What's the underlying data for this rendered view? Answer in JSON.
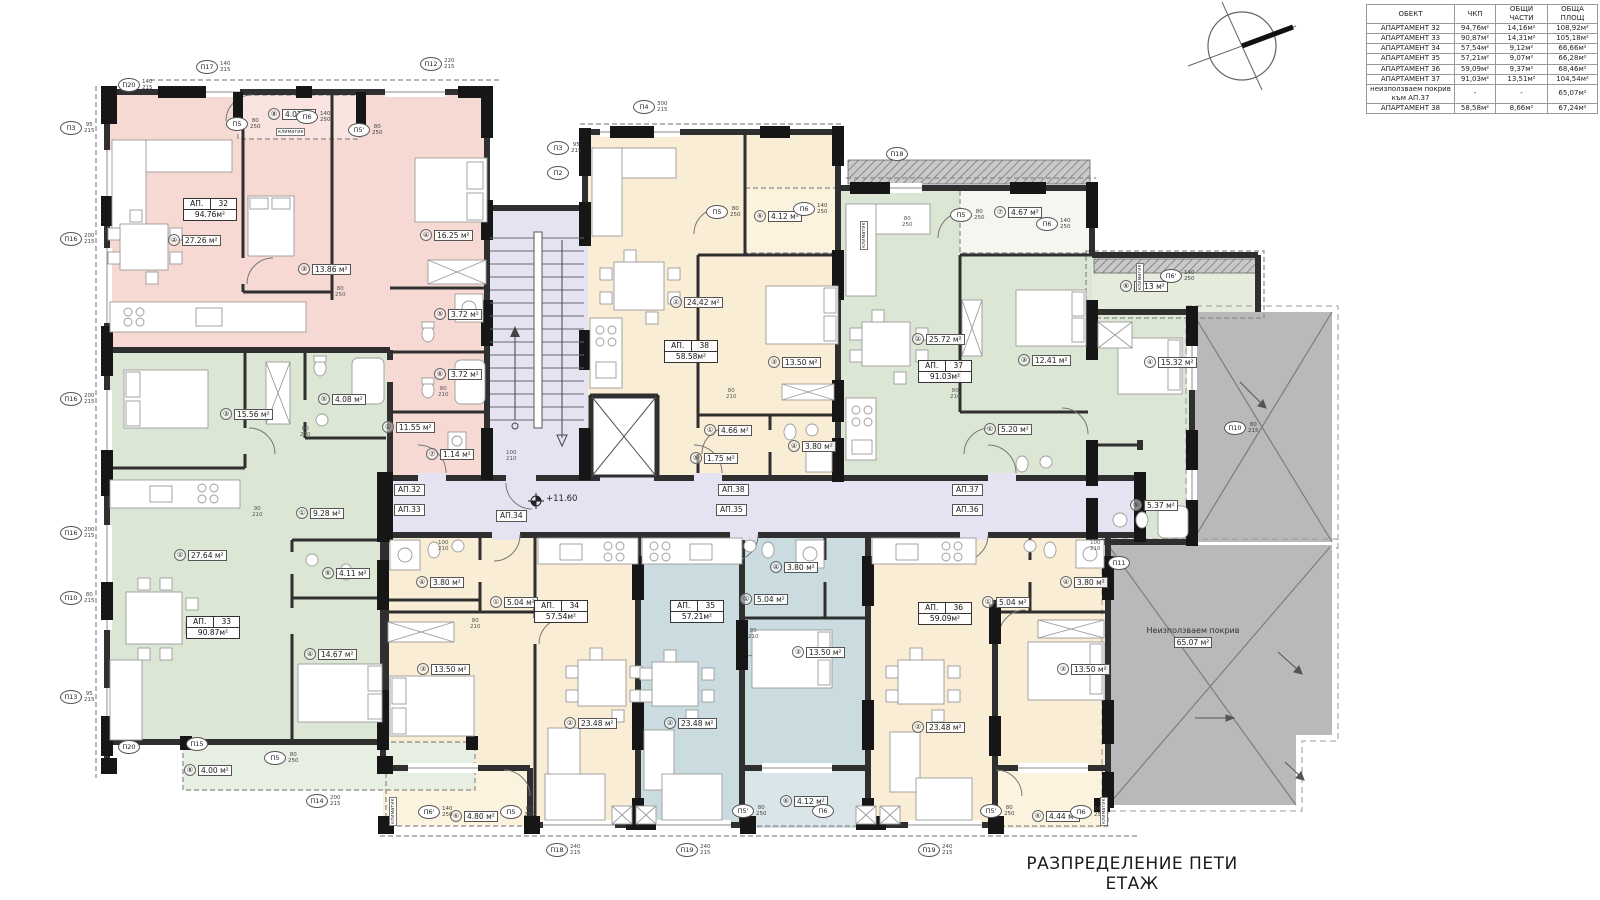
{
  "title": "РАЗПРЕДЕЛЕНИЕ ПЕТИ ЕТАЖ",
  "level_mark": "+11.60",
  "roof": {
    "label": "Неизползваем покрив",
    "area": "65.07 м²"
  },
  "table": {
    "headers": [
      "ОБЕКТ",
      "ЧКП",
      "ОБЩИ ЧАСТИ",
      "ОБЩА ПЛОЩ"
    ],
    "rows": [
      [
        "АПАРТАМЕНТ 32",
        "94,76м²",
        "14,16м²",
        "108,92м²"
      ],
      [
        "АПАРТАМЕНТ 33",
        "90,87м²",
        "14,31м²",
        "105,18м²"
      ],
      [
        "АПАРТАМЕНТ 34",
        "57,54м²",
        "9,12м²",
        "66,66м²"
      ],
      [
        "АПАРТАМЕНТ 35",
        "57,21м²",
        "9,07м²",
        "66,28м²"
      ],
      [
        "АПАРТАМЕНТ 36",
        "59,09м²",
        "9,37м²",
        "68,46м²"
      ],
      [
        "АПАРТАМЕНТ 37",
        "91,03м²",
        "13,51м²",
        "104,54м²"
      ],
      [
        "неизползваем покрив към АП.37",
        "-",
        "-",
        "65,07м²"
      ],
      [
        "АПАРТАМЕНТ 38",
        "58,58м²",
        "8,66м²",
        "67,24м²"
      ]
    ]
  },
  "apartments": [
    {
      "prefix": "АП.",
      "num": "32",
      "area": "94.76м²",
      "x": 183,
      "y": 198
    },
    {
      "prefix": "АП.",
      "num": "33",
      "area": "90.87м²",
      "x": 186,
      "y": 616
    },
    {
      "prefix": "АП.",
      "num": "38",
      "area": "58.58м²",
      "x": 664,
      "y": 340
    },
    {
      "prefix": "АП.",
      "num": "37",
      "area": "91.03м²",
      "x": 918,
      "y": 360
    },
    {
      "prefix": "АП.",
      "num": "34",
      "area": "57.54м²",
      "x": 534,
      "y": 600
    },
    {
      "prefix": "АП.",
      "num": "35",
      "area": "57.21м²",
      "x": 670,
      "y": 600
    },
    {
      "prefix": "АП.",
      "num": "36",
      "area": "59.09м²",
      "x": 918,
      "y": 602
    }
  ],
  "rooms": [
    {
      "n": "⑧",
      "a": "4.01 м²",
      "x": 268,
      "y": 108
    },
    {
      "n": "②",
      "a": "27.26 м²",
      "x": 168,
      "y": 234
    },
    {
      "n": "③",
      "a": "13.86 м²",
      "x": 298,
      "y": 263
    },
    {
      "n": "④",
      "a": "16.25 м²",
      "x": 420,
      "y": 229
    },
    {
      "n": "⑤",
      "a": "3.72 м²",
      "x": 434,
      "y": 308
    },
    {
      "n": "⑥",
      "a": "3.72 м²",
      "x": 434,
      "y": 368
    },
    {
      "n": "①",
      "a": "11.55 м²",
      "x": 382,
      "y": 421
    },
    {
      "n": "⑦",
      "a": "1.14 м²",
      "x": 426,
      "y": 448
    },
    {
      "n": "③",
      "a": "15.56 м²",
      "x": 220,
      "y": 408
    },
    {
      "n": "⑤",
      "a": "4.08 м²",
      "x": 318,
      "y": 393
    },
    {
      "n": "①",
      "a": "9.28 м²",
      "x": 296,
      "y": 507
    },
    {
      "n": "②",
      "a": "27.64 м²",
      "x": 174,
      "y": 549
    },
    {
      "n": "⑥",
      "a": "4.11 м²",
      "x": 322,
      "y": 567
    },
    {
      "n": "④",
      "a": "14.67 м²",
      "x": 304,
      "y": 648
    },
    {
      "n": "⑧",
      "a": "4.00 м²",
      "x": 184,
      "y": 764
    },
    {
      "n": "⑥",
      "a": "4.12 м²",
      "x": 754,
      "y": 210
    },
    {
      "n": "②",
      "a": "24.42 м²",
      "x": 670,
      "y": 296
    },
    {
      "n": "③",
      "a": "13.50 м²",
      "x": 768,
      "y": 356
    },
    {
      "n": "①",
      "a": "4.66 м²",
      "x": 704,
      "y": 424
    },
    {
      "n": "④",
      "a": "3.80 м²",
      "x": 788,
      "y": 440
    },
    {
      "n": "⑤",
      "a": "1.75 м²",
      "x": 690,
      "y": 452
    },
    {
      "n": "⑦",
      "a": "4.67 м²",
      "x": 994,
      "y": 206
    },
    {
      "n": "②",
      "a": "25.72 м²",
      "x": 912,
      "y": 333
    },
    {
      "n": "③",
      "a": "12.41 м²",
      "x": 1018,
      "y": 354
    },
    {
      "n": "⑧",
      "a": "5.13 м²",
      "x": 1120,
      "y": 280
    },
    {
      "n": "④",
      "a": "15.32 м²",
      "x": 1144,
      "y": 356
    },
    {
      "n": "①",
      "a": "5.20 м²",
      "x": 984,
      "y": 423
    },
    {
      "n": "⑤",
      "a": "5.37 м²",
      "x": 1130,
      "y": 499
    },
    {
      "n": "④",
      "a": "3.80 м²",
      "x": 416,
      "y": 576
    },
    {
      "n": "①",
      "a": "5.04 м²",
      "x": 490,
      "y": 596
    },
    {
      "n": "③",
      "a": "13.50 м²",
      "x": 417,
      "y": 663
    },
    {
      "n": "②",
      "a": "23.48 м²",
      "x": 564,
      "y": 717
    },
    {
      "n": "⑥",
      "a": "4.80 м²",
      "x": 450,
      "y": 810
    },
    {
      "n": "④",
      "a": "3.80 м²",
      "x": 770,
      "y": 561
    },
    {
      "n": "①",
      "a": "5.04 м²",
      "x": 740,
      "y": 593
    },
    {
      "n": "③",
      "a": "13.50 м²",
      "x": 792,
      "y": 646
    },
    {
      "n": "②",
      "a": "23.48 м²",
      "x": 664,
      "y": 717
    },
    {
      "n": "⑥",
      "a": "4.12 м²",
      "x": 780,
      "y": 795
    },
    {
      "n": "④",
      "a": "3.80 м²",
      "x": 1060,
      "y": 576
    },
    {
      "n": "①",
      "a": "5.04 м²",
      "x": 982,
      "y": 596
    },
    {
      "n": "③",
      "a": "13.50 м²",
      "x": 1057,
      "y": 663
    },
    {
      "n": "②",
      "a": "23.48 м²",
      "x": 912,
      "y": 721
    },
    {
      "n": "⑥",
      "a": "4.44 м²",
      "x": 1032,
      "y": 810
    }
  ],
  "corridor_labels": [
    {
      "t": "АП.32",
      "x": 394,
      "y": 484
    },
    {
      "t": "АП.33",
      "x": 394,
      "y": 504
    },
    {
      "t": "АП.34",
      "x": 496,
      "y": 510
    },
    {
      "t": "АП.38",
      "x": 718,
      "y": 484
    },
    {
      "t": "АП.35",
      "x": 716,
      "y": 504
    },
    {
      "t": "АП.37",
      "x": 952,
      "y": 484
    },
    {
      "t": "АП.36",
      "x": 952,
      "y": 504
    }
  ],
  "markers": [
    {
      "t": "П20",
      "d": "140/215",
      "x": 118,
      "y": 78
    },
    {
      "t": "П17",
      "d": "140/215",
      "x": 196,
      "y": 60
    },
    {
      "t": "П12",
      "d": "220/215",
      "x": 420,
      "y": 57
    },
    {
      "t": "П4",
      "d": "300/215",
      "x": 633,
      "y": 100
    },
    {
      "t": "П3",
      "d": "95/215",
      "x": 547,
      "y": 141
    },
    {
      "t": "П2",
      "d": "",
      "x": 547,
      "y": 166
    },
    {
      "t": "П18",
      "d": "",
      "x": 886,
      "y": 147
    },
    {
      "t": "П3",
      "d": "95/215",
      "x": 60,
      "y": 121
    },
    {
      "t": "П16",
      "d": "200/215",
      "x": 60,
      "y": 232
    },
    {
      "t": "П16",
      "d": "200/215",
      "x": 60,
      "y": 392
    },
    {
      "t": "П16",
      "d": "200/215",
      "x": 60,
      "y": 526
    },
    {
      "t": "П10",
      "d": "80/215",
      "x": 60,
      "y": 591
    },
    {
      "t": "П13",
      "d": "95/215",
      "x": 60,
      "y": 690
    },
    {
      "t": "П20",
      "d": "",
      "x": 118,
      "y": 740
    },
    {
      "t": "П15",
      "d": "",
      "x": 186,
      "y": 737
    },
    {
      "t": "П14",
      "d": "200/215",
      "x": 306,
      "y": 794
    },
    {
      "t": "П18",
      "d": "240/215",
      "x": 546,
      "y": 843
    },
    {
      "t": "П19",
      "d": "240/215",
      "x": 676,
      "y": 843
    },
    {
      "t": "П19",
      "d": "240/215",
      "x": 918,
      "y": 843
    },
    {
      "t": "П11",
      "d": "",
      "x": 1108,
      "y": 556
    },
    {
      "t": "П10",
      "d": "80/215",
      "x": 1224,
      "y": 421
    }
  ],
  "doors": [
    {
      "t": "П5",
      "d": "80/250",
      "x": 226,
      "y": 117
    },
    {
      "t": "П6",
      "d": "140/250",
      "x": 296,
      "y": 110
    },
    {
      "t": "П5'",
      "d": "80/250",
      "x": 348,
      "y": 123
    },
    {
      "t": "П5",
      "d": "80/250",
      "x": 706,
      "y": 205
    },
    {
      "t": "П6",
      "d": "140/250",
      "x": 793,
      "y": 202
    },
    {
      "t": "П5",
      "d": "80/250",
      "x": 950,
      "y": 208
    },
    {
      "t": "П6",
      "d": "140/250",
      "x": 1036,
      "y": 217
    },
    {
      "t": "П6'",
      "d": "140/250",
      "x": 1160,
      "y": 269
    },
    {
      "t": "П6'",
      "d": "140/250",
      "x": 418,
      "y": 805
    },
    {
      "t": "П5",
      "d": "80/250",
      "x": 500,
      "y": 805
    },
    {
      "t": "П5'",
      "d": "80/250",
      "x": 732,
      "y": 804
    },
    {
      "t": "П6",
      "d": "",
      "x": 812,
      "y": 804
    },
    {
      "t": "П5'",
      "d": "80/250",
      "x": 980,
      "y": 804
    },
    {
      "t": "П6",
      "d": "140/250",
      "x": 1070,
      "y": 805
    },
    {
      "t": "П5",
      "d": "80/250",
      "x": 264,
      "y": 751
    }
  ],
  "dims": [
    {
      "t": "80/210",
      "x": 300,
      "y": 426
    },
    {
      "t": "80/210",
      "x": 438,
      "y": 386
    },
    {
      "t": "80/250",
      "x": 335,
      "y": 286
    },
    {
      "t": "100/210",
      "x": 506,
      "y": 450
    },
    {
      "t": "80/210",
      "x": 726,
      "y": 388
    },
    {
      "t": "90/210",
      "x": 252,
      "y": 506
    },
    {
      "t": "80/210",
      "x": 950,
      "y": 388
    },
    {
      "t": "80/250",
      "x": 902,
      "y": 216
    },
    {
      "t": "80/210",
      "x": 470,
      "y": 618
    },
    {
      "t": "80/210",
      "x": 748,
      "y": 628
    },
    {
      "t": "100/210",
      "x": 438,
      "y": 540
    },
    {
      "t": "100/210",
      "x": 1090,
      "y": 540
    }
  ],
  "notes": [
    {
      "t": "климатик",
      "v": false,
      "x": 276,
      "y": 128
    },
    {
      "t": "климатик",
      "v": true,
      "x": 1136,
      "y": 292
    },
    {
      "t": "климатик",
      "v": true,
      "x": 389,
      "y": 826
    },
    {
      "t": "климатик",
      "v": true,
      "x": 1100,
      "y": 826
    },
    {
      "t": "климатик",
      "v": true,
      "x": 860,
      "y": 250
    }
  ]
}
